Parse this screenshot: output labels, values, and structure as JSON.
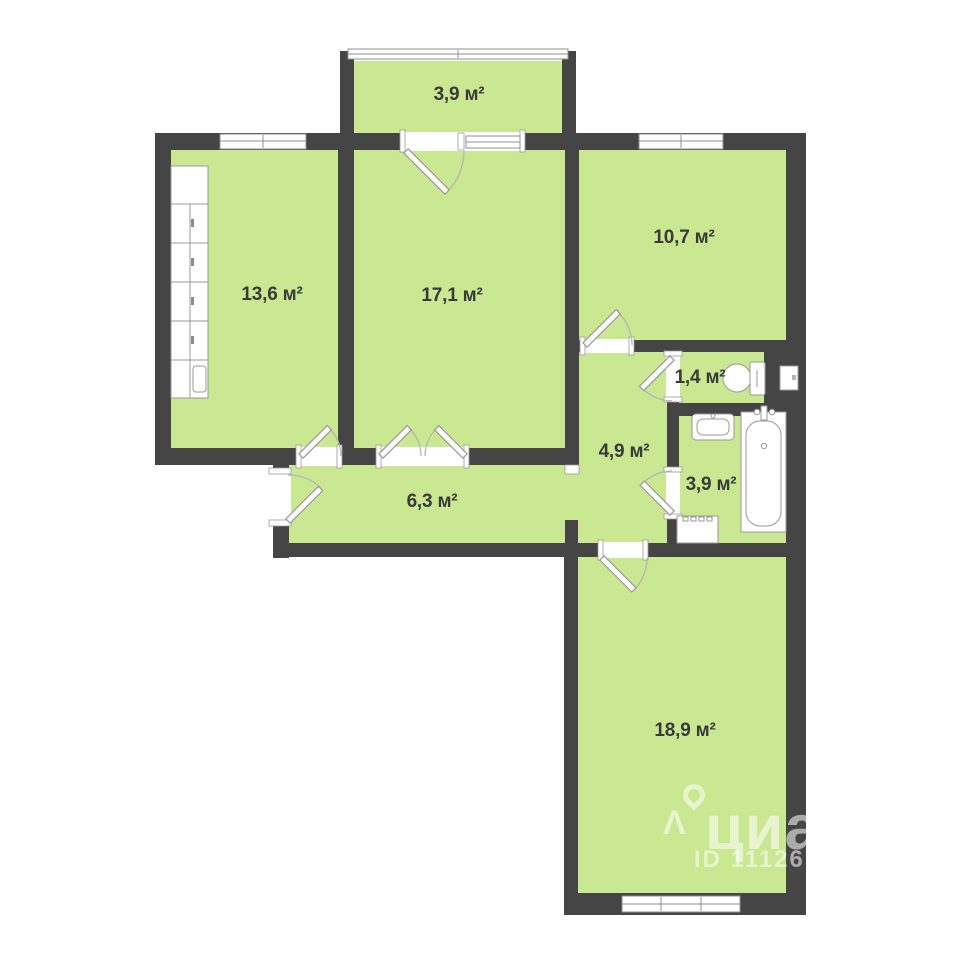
{
  "plan": {
    "title": "apartment-floor-plan",
    "rooms": [
      {
        "id": "balcony",
        "label": "3,9 м²"
      },
      {
        "id": "kitchen",
        "label": "13,6 м²"
      },
      {
        "id": "living-room",
        "label": "17,1 м²"
      },
      {
        "id": "bedroom",
        "label": "10,7 м²"
      },
      {
        "id": "wc",
        "label": "1,4 м²"
      },
      {
        "id": "corridor",
        "label": "4,9 м²"
      },
      {
        "id": "bathroom",
        "label": "3,9 м²"
      },
      {
        "id": "hallway",
        "label": "6,3 м²"
      },
      {
        "id": "big-room",
        "label": "18,9 м²"
      }
    ],
    "fixtures": [
      "kitchen-cabinets-icon",
      "toilet-icon",
      "sink-icon",
      "bathtub-icon",
      "washing-machine-icon",
      "vent-shaft-icon"
    ],
    "watermark": {
      "brand": "циан",
      "listing_id": "ID 11126",
      "pin_icon": "map-pin-icon",
      "caret_icon": "caret-icon"
    },
    "colors": {
      "wall": "#454545",
      "room_fill": "#cae791",
      "fixture_stroke": "#9a9a9a",
      "label_text": "#3a3a3a",
      "background": "#ffffff"
    }
  }
}
